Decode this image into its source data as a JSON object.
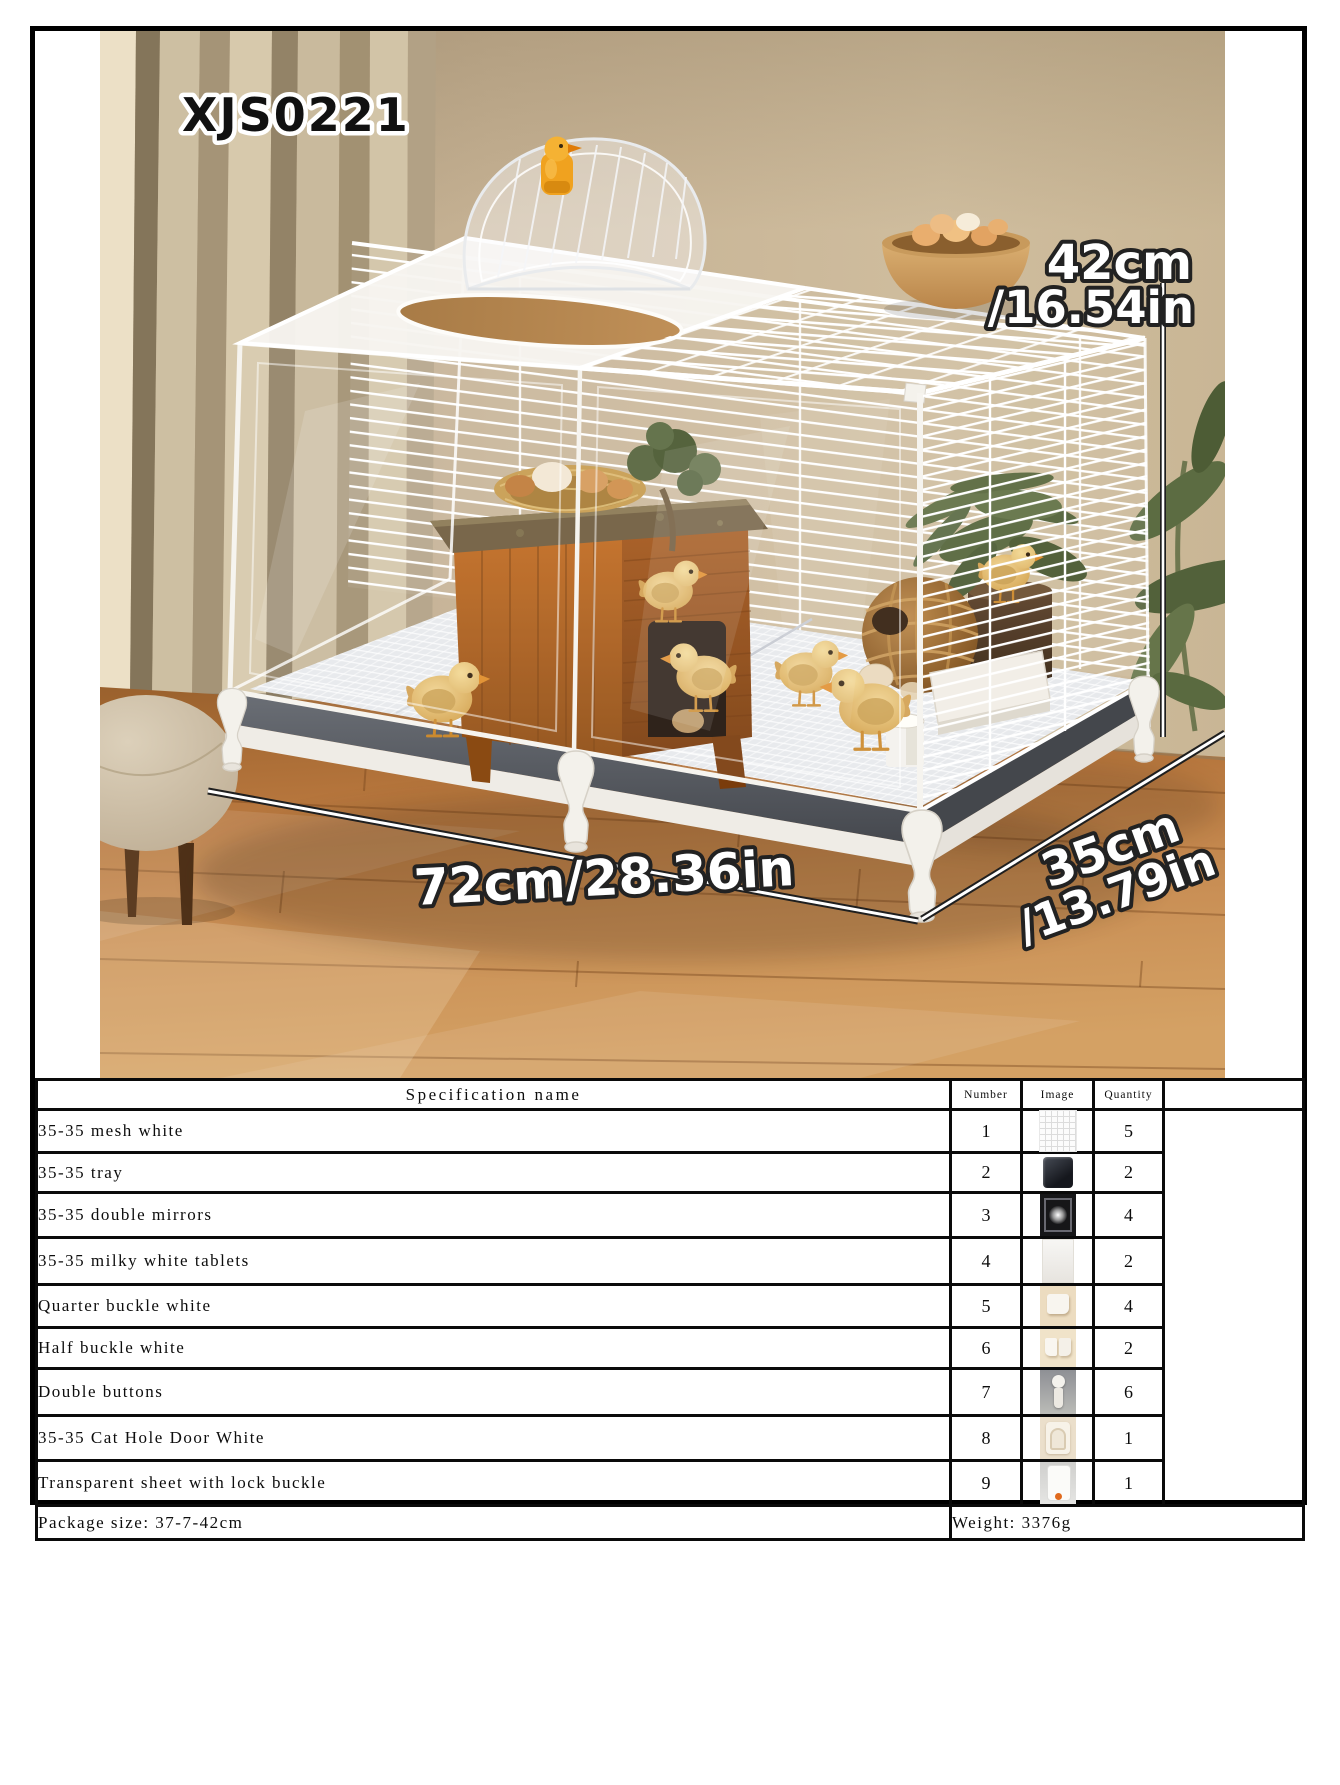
{
  "photo": {
    "model": "XJS0221",
    "labels": {
      "height": "42cm",
      "height_in": "/16.54in",
      "width": "72cm/28.36in",
      "depth": "35cm",
      "depth_in": "/13.79in"
    },
    "colors": {
      "wall": "#c6b294",
      "curtain": "#b4a388",
      "wood_floor": "#b5753c",
      "cage_white": "#f3f1eb",
      "tray_gray": "#4a4d53",
      "chick_yellow": "#dfb164",
      "duck_clip_orange": "#f0a21f"
    }
  },
  "spec_table": {
    "header": {
      "name": "Specification name",
      "number": "Number",
      "image": "Image",
      "quantity": "Quantity"
    },
    "rows": [
      {
        "name": "35-35 mesh white",
        "number": "1",
        "quantity": "5",
        "image": "white mesh panel"
      },
      {
        "name": "35-35 tray",
        "number": "2",
        "quantity": "2",
        "image": "dark tray"
      },
      {
        "name": "35-35 double mirrors",
        "number": "3",
        "quantity": "4",
        "image": "reflective panel"
      },
      {
        "name": "35-35 milky white tablets",
        "number": "4",
        "quantity": "2",
        "image": "milky white panel"
      },
      {
        "name": "Quarter buckle white",
        "number": "5",
        "quantity": "4",
        "image": "quarter buckle"
      },
      {
        "name": "Half buckle white",
        "number": "6",
        "quantity": "2",
        "image": "half buckle"
      },
      {
        "name": "Double buttons",
        "number": "7",
        "quantity": "6",
        "image": "double button"
      },
      {
        "name": "35-35 Cat Hole Door White",
        "number": "8",
        "quantity": "1",
        "image": "cat hole door"
      },
      {
        "name": "Transparent sheet with lock buckle",
        "number": "9",
        "quantity": "1",
        "image": "transparent sheet with lock buckle"
      }
    ],
    "footer": {
      "package_size": "Package size: 37-7-42cm",
      "weight": "Weight: 3376g"
    }
  }
}
